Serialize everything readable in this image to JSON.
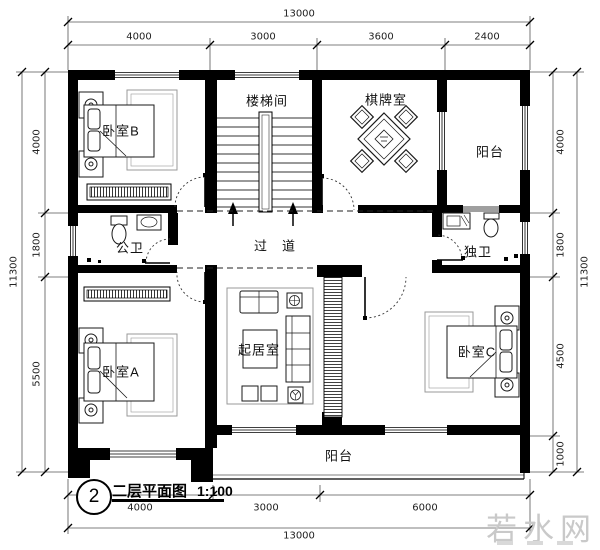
{
  "title_block": {
    "number": "2",
    "title": "二层平面图",
    "scale": "1:100"
  },
  "watermark": {
    "text": "若水网"
  },
  "rooms": {
    "bedroom_b": "卧室B",
    "stairwell": "楼梯间",
    "game_room": "棋牌室",
    "balcony_top": "阳台",
    "public_bath": "公卫",
    "corridor": "过　道",
    "private_bath": "独卫",
    "bedroom_a": "卧室A",
    "living_room": "起居室",
    "bedroom_c": "卧室C",
    "balcony_bottom": "阳台"
  },
  "dimensions": {
    "top": {
      "total": "13000",
      "segments": [
        "4000",
        "3000",
        "3600",
        "2400"
      ]
    },
    "bottom": {
      "total": "13000",
      "segments": [
        "4000",
        "3000",
        "6000"
      ]
    },
    "left": {
      "total": "11300",
      "segments": [
        "4000",
        "1800",
        "5500"
      ]
    },
    "right": {
      "total": "11300",
      "segments": [
        "4000",
        "1800",
        "4500",
        "1000"
      ]
    }
  },
  "colors": {
    "wall": "#000000",
    "dim_line": "#444444",
    "watermark": "#c9c9c9"
  }
}
